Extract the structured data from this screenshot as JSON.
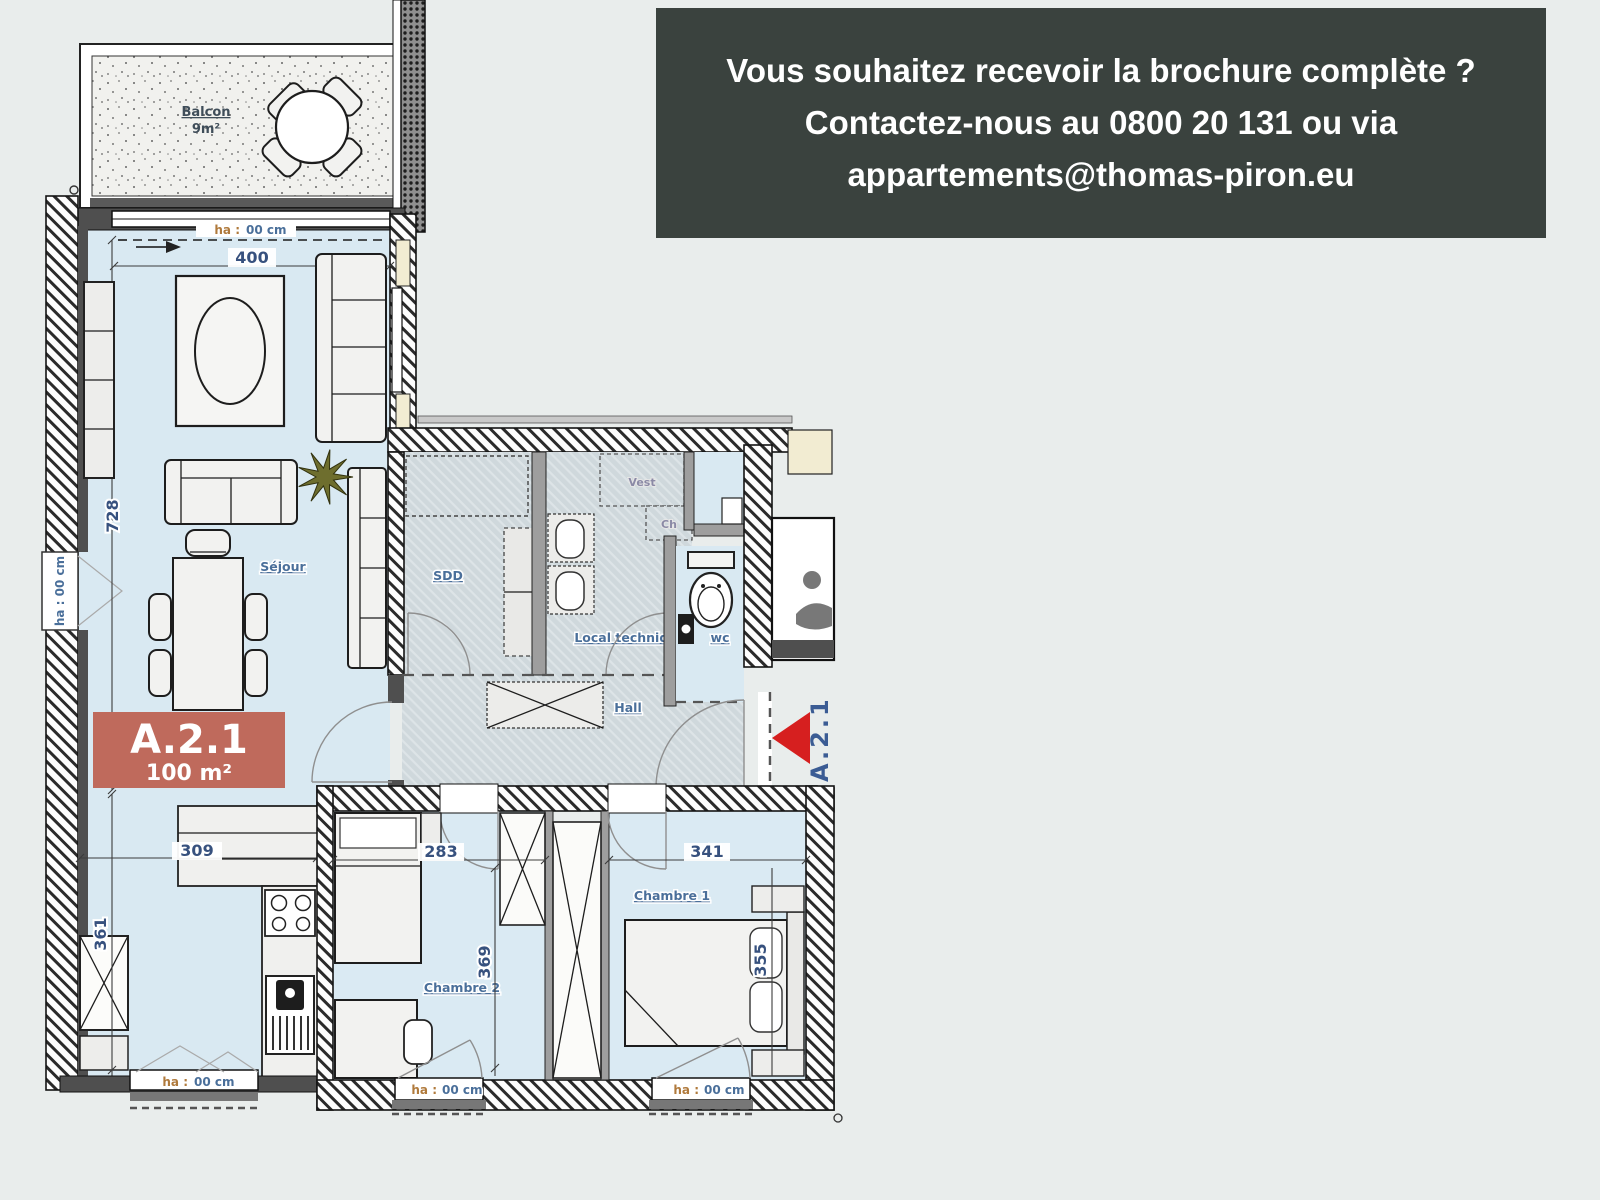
{
  "banner": {
    "lines": [
      "Vous souhaitez recevoir la brochure complète ?",
      "Contactez-nous au 0800 20 131 ou via",
      "appartements@thomas-piron.eu"
    ],
    "phone": "0800 20 131",
    "email": "appartements@thomas-piron.eu",
    "background": "#3a423e",
    "text_color": "#ffffff"
  },
  "unit": {
    "code": "A.2.1",
    "area": "100 m²",
    "badge_color": "#bf6a5c"
  },
  "entrance": {
    "label": "A.2.1",
    "arrow_color": "#d61f1f"
  },
  "rooms": {
    "balcony": {
      "name": "Balcon",
      "area": "9m²"
    },
    "living": {
      "name": "Séjour"
    },
    "shower_room": {
      "name": "SDD"
    },
    "technical_room": {
      "name": "Local technique"
    },
    "closet": {
      "name": "Vest"
    },
    "boiler": {
      "name": "Ch"
    },
    "wc": {
      "name": "wc"
    },
    "hall": {
      "name": "Hall"
    },
    "bedroom1": {
      "name": "Chambre 1"
    },
    "bedroom2": {
      "name": "Chambre 2"
    }
  },
  "dimensions_cm": {
    "living_width": "400",
    "living_length": "728",
    "kitchen_width": "309",
    "kitchen_depth": "361",
    "bedroom2_width": "283",
    "bedroom2_depth": "369",
    "bedroom1_width": "341",
    "bedroom1_depth": "355"
  },
  "window_annotation": {
    "prefix": "ha :",
    "value": "00 cm",
    "full": "ha : 00 cm"
  },
  "colors": {
    "page_background": "#e9edec",
    "floor_blue": "#d9e9f2",
    "service_floor": "#cfd8dc",
    "wall_dark": "#4f4f4f",
    "label_blue": "#4a6f9a",
    "dim_blue": "#37517e",
    "cream": "#f2ecd2",
    "plant_green": "#6e6e2e"
  }
}
